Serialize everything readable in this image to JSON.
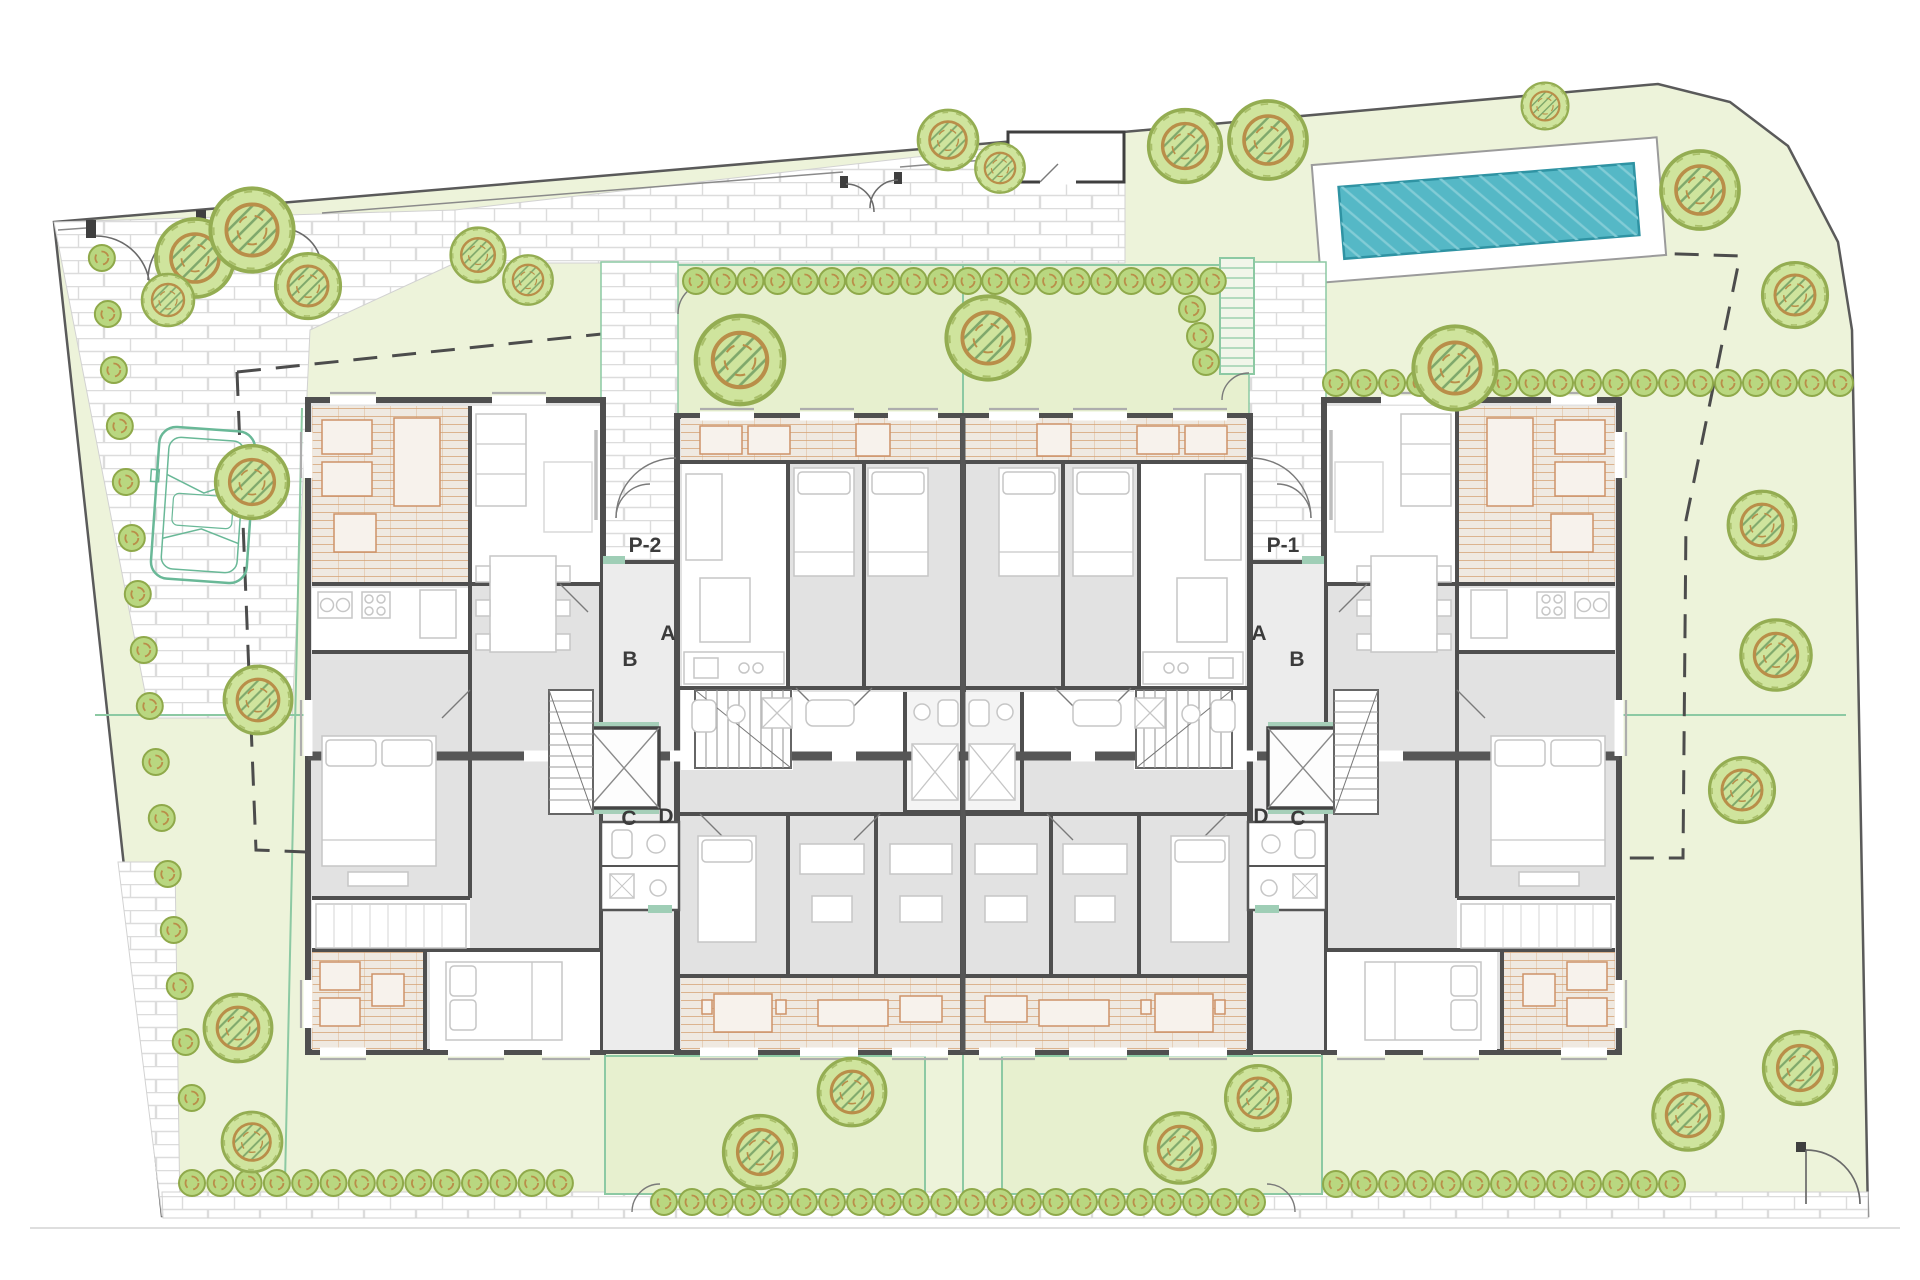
{
  "portals": {
    "left": {
      "label": "P-2",
      "a": "A",
      "b": "B",
      "c": "C",
      "d": "D"
    },
    "right": {
      "label": "P-1",
      "a": "A",
      "b": "B",
      "c": "C",
      "d": "D"
    }
  },
  "colors": {
    "lawn": "#edf3da",
    "garden_fill": "#e7f0cf",
    "hedge_teal": "#8cc9a3",
    "pool_water": "#55b8c6",
    "pool_border": "#2f93a3",
    "wall": "#4f4f4f",
    "floor_gray": "#e2e2e2",
    "terrace_joint": "#d4a173",
    "pavement_joint": "#dcdcdc",
    "tree_green": "#cfe49d",
    "bush_green": "#b9d780",
    "boundary_dash": "#4c4c4c",
    "car_outline": "#69b897",
    "label_ink": "#3b3b3b"
  }
}
